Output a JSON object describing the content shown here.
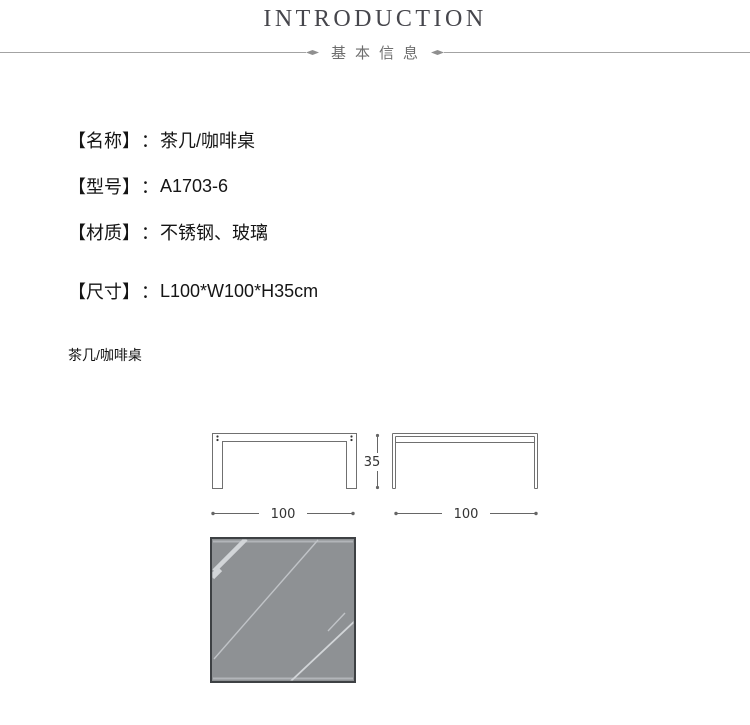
{
  "header": {
    "title": "INTRODUCTION",
    "subtitle": "基本信息"
  },
  "specs": {
    "separator": "：",
    "items": [
      {
        "label": "【名称】",
        "value": "茶几/咖啡桌"
      },
      {
        "label": "【型号】",
        "value": "A1703-6"
      },
      {
        "label": "【材质】",
        "value": "不锈钢、玻璃"
      },
      {
        "label": "【尺寸】",
        "value": "L100*W100*H35cm"
      }
    ]
  },
  "drawings": {
    "caption": "茶几/咖啡桌",
    "front_view": {
      "width_label": "100",
      "height_label": "35"
    },
    "side_view": {
      "width_label": "100"
    }
  },
  "colors": {
    "title_text": "#46464c",
    "subtitle_text": "#6e6e6e",
    "divider_line": "#a3a3a3",
    "divider_diamond": "#8f8f8f",
    "spec_text": "#151515",
    "drawing_line": "#707070",
    "dim_line": "#666666",
    "dim_text": "#333333",
    "glass_fill": "#8e9194",
    "glass_border": "#3e4144",
    "glass_bevel": "#b2b5b9",
    "glass_streak_bright": "#d2d5d8",
    "glass_streak_mid": "#c0c3c7"
  }
}
